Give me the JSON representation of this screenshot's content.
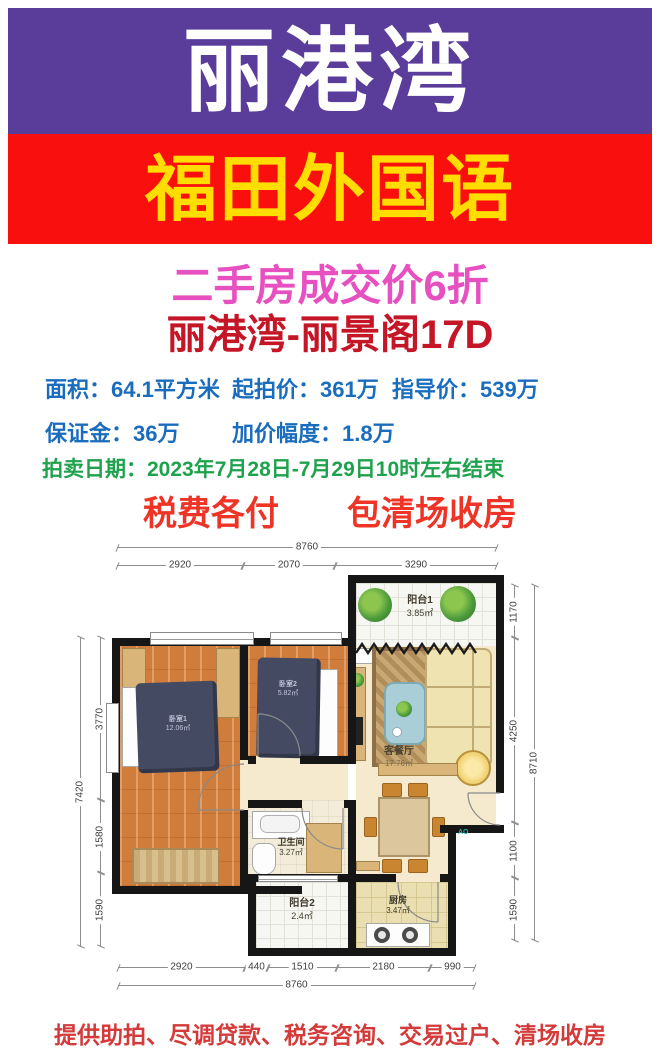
{
  "banner": {
    "estate_name": "丽港湾",
    "school_name": "福田外国语"
  },
  "headlines": {
    "promo": "二手房成交价6折",
    "unit": "丽港湾-丽景阁17D",
    "tax_note": "税费各付　　包清场收房"
  },
  "info": {
    "area": "面积：64.1平方米",
    "start_price": "起拍价：361万",
    "guide_price": "指导价：539万",
    "deposit": "保证金：36万",
    "increment": "加价幅度：1.8万",
    "auction_date": "拍卖日期：2023年7月28日-7月29日10时左右结束"
  },
  "floorplan": {
    "rooms": {
      "balcony1": {
        "name": "阳台1",
        "area": "3.85㎡"
      },
      "bedroom1": {
        "name": "卧室1",
        "area": "12.06㎡"
      },
      "bedroom2": {
        "name": "卧室2",
        "area": "5.82㎡"
      },
      "living": {
        "name": "客餐厅",
        "area": "17.76㎡"
      },
      "bathroom": {
        "name": "卫生间",
        "area": "3.27㎡"
      },
      "balcony2": {
        "name": "阳台2",
        "area": "2.4㎡"
      },
      "kitchen": {
        "name": "厨房",
        "area": "3.47㎡"
      }
    },
    "dims": {
      "top_total": "8760",
      "top": [
        "2920",
        "2070",
        "3290"
      ],
      "bottom": [
        "2920",
        "440",
        "1510",
        "2180",
        "990"
      ],
      "bottom_total": "8760",
      "left_total": "7420",
      "left": [
        "3770",
        "1580",
        "1590"
      ],
      "right_total": "8710",
      "right": [
        "1170",
        "4250",
        "1100",
        "1590"
      ]
    },
    "watermark": "AO"
  },
  "footer": {
    "services": "提供助拍、尽调贷款、税务咨询、交易过户、清场收房"
  },
  "colors": {
    "banner_purple": "#5a3d9a",
    "banner_red": "#fa0f0f",
    "banner_yellow": "#ffdd00",
    "promo_pink": "#e750c0",
    "unit_crimson": "#c41626",
    "info_blue": "#1a6cbd",
    "date_green": "#1ea24c",
    "tax_red": "#ee3426",
    "footer_red": "#d43a3a"
  }
}
